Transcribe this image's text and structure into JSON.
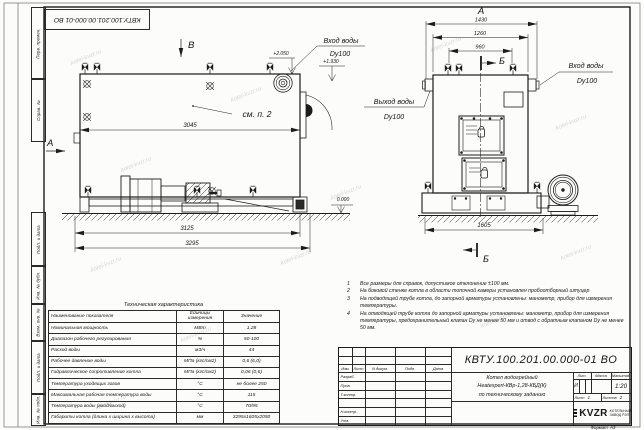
{
  "watermark": {
    "text": "kotel-kvzr.ru"
  },
  "margins": {
    "top_stamp": "КВТУ.100.201.00.000-01 ВО",
    "cells": [
      "Перв. примен.",
      "Справ. №",
      "Подп. и дата",
      "Инв. № дубл.",
      "Взам. инв. №",
      "Подп. и дата",
      "Инв. № подл."
    ]
  },
  "side_view": {
    "view_a": "А",
    "view_b": "В",
    "dim_3045": "3045",
    "dim_3125": "3125",
    "dim_3295": "3295",
    "elev_top": "+2.050",
    "elev_mid": "+1.930",
    "elev_zero": "0.000",
    "see_note": "см. п. 2",
    "inlet_label": "Вход воды",
    "inlet_dn": "Dy100"
  },
  "front_view": {
    "view_label": "А",
    "section_top": "Б",
    "section_bottom": "Б",
    "dim_1430": "1430",
    "dim_1260": "1260",
    "dim_960": "960",
    "dim_1605": "1605",
    "inlet_label": "Вход воды",
    "inlet_dn": "Dy100",
    "outlet_label": "Выход воды",
    "outlet_dn": "Dy100"
  },
  "notes": [
    {
      "num": "1",
      "text": "Все размеры для справок, допустимое отклонение  ±100 мм."
    },
    {
      "num": "2",
      "text": "На боковой стенке котла в области топочной камеры установлен пробоотборный штуцер"
    },
    {
      "num": "3",
      "text": "На  подводящей трубе котла, до запорной арматуры установлены: манометр, прибор для измерения температуры."
    },
    {
      "num": "4",
      "text": "На отводящей трубе котла до запорной арматуры установлены: манометр, прибор для измерения температуры, предохранительный клапан Dу не менее 50 мм и отвод с обратным клапаном Dу не менее 50 мм."
    }
  ],
  "spec_table": {
    "title": "Техническая характеристика",
    "headers": [
      "Наименование показателя",
      "Единицы измерения",
      "Значение"
    ],
    "rows": [
      {
        "name": "Номинальная мощность",
        "unit": "МВт",
        "value": "1,28"
      },
      {
        "name": "Диапазон рабочего регулирования",
        "unit": "%",
        "value": "50-100"
      },
      {
        "name": "Расход воды",
        "unit": "м3/ч",
        "value": "44"
      },
      {
        "name": "Рабочее давление воды",
        "unit": "МПа (кгс/см2)",
        "value": "0,6 (6,0)"
      },
      {
        "name": "Гидравлическое сопротивление котла",
        "unit": "МПа (кгс/см2)",
        "value": "0,06 (0,6)"
      },
      {
        "name": "Температура уходящих газов",
        "unit": "°С",
        "value": "не более 250"
      },
      {
        "name": "Максимальная рабочая температура воды",
        "unit": "°С",
        "value": "115"
      },
      {
        "name": "Температура воды (вход/выход)",
        "unit": "°С",
        "value": "70/95"
      },
      {
        "name": "Габариты котла (длина х ширина х высота)",
        "unit": "мм",
        "value": "3295х1605х2050"
      }
    ]
  },
  "title_block": {
    "doc_number": "КВТУ.100.201.00.000-01 ВО",
    "cols": [
      "Изм.",
      "Лист",
      "N докум.",
      "Подп.",
      "Дата"
    ],
    "roles": [
      "Разраб.",
      "Пров.",
      "Т.контр.",
      "",
      "Н.контр.",
      "Утв."
    ],
    "product": [
      "Котел водогрейный",
      "Heatexpert-КВр-1,28-КБД(К)",
      "по техническому заданию"
    ],
    "lit_label": "Лит.",
    "mass_label": "Масса",
    "scale_label": "Масштаб",
    "lit_value": "И",
    "scale_value": "1:20",
    "sheet_label": "Лист",
    "sheet_value": "1",
    "sheets_label": "Листов",
    "sheets_value": "2",
    "logo": "KVZR",
    "company_line1": "КОТЕЛЬНЫЙ",
    "company_line2": "ЗАВОД РЭП",
    "format_label": "Формат",
    "format_value": "А3"
  }
}
